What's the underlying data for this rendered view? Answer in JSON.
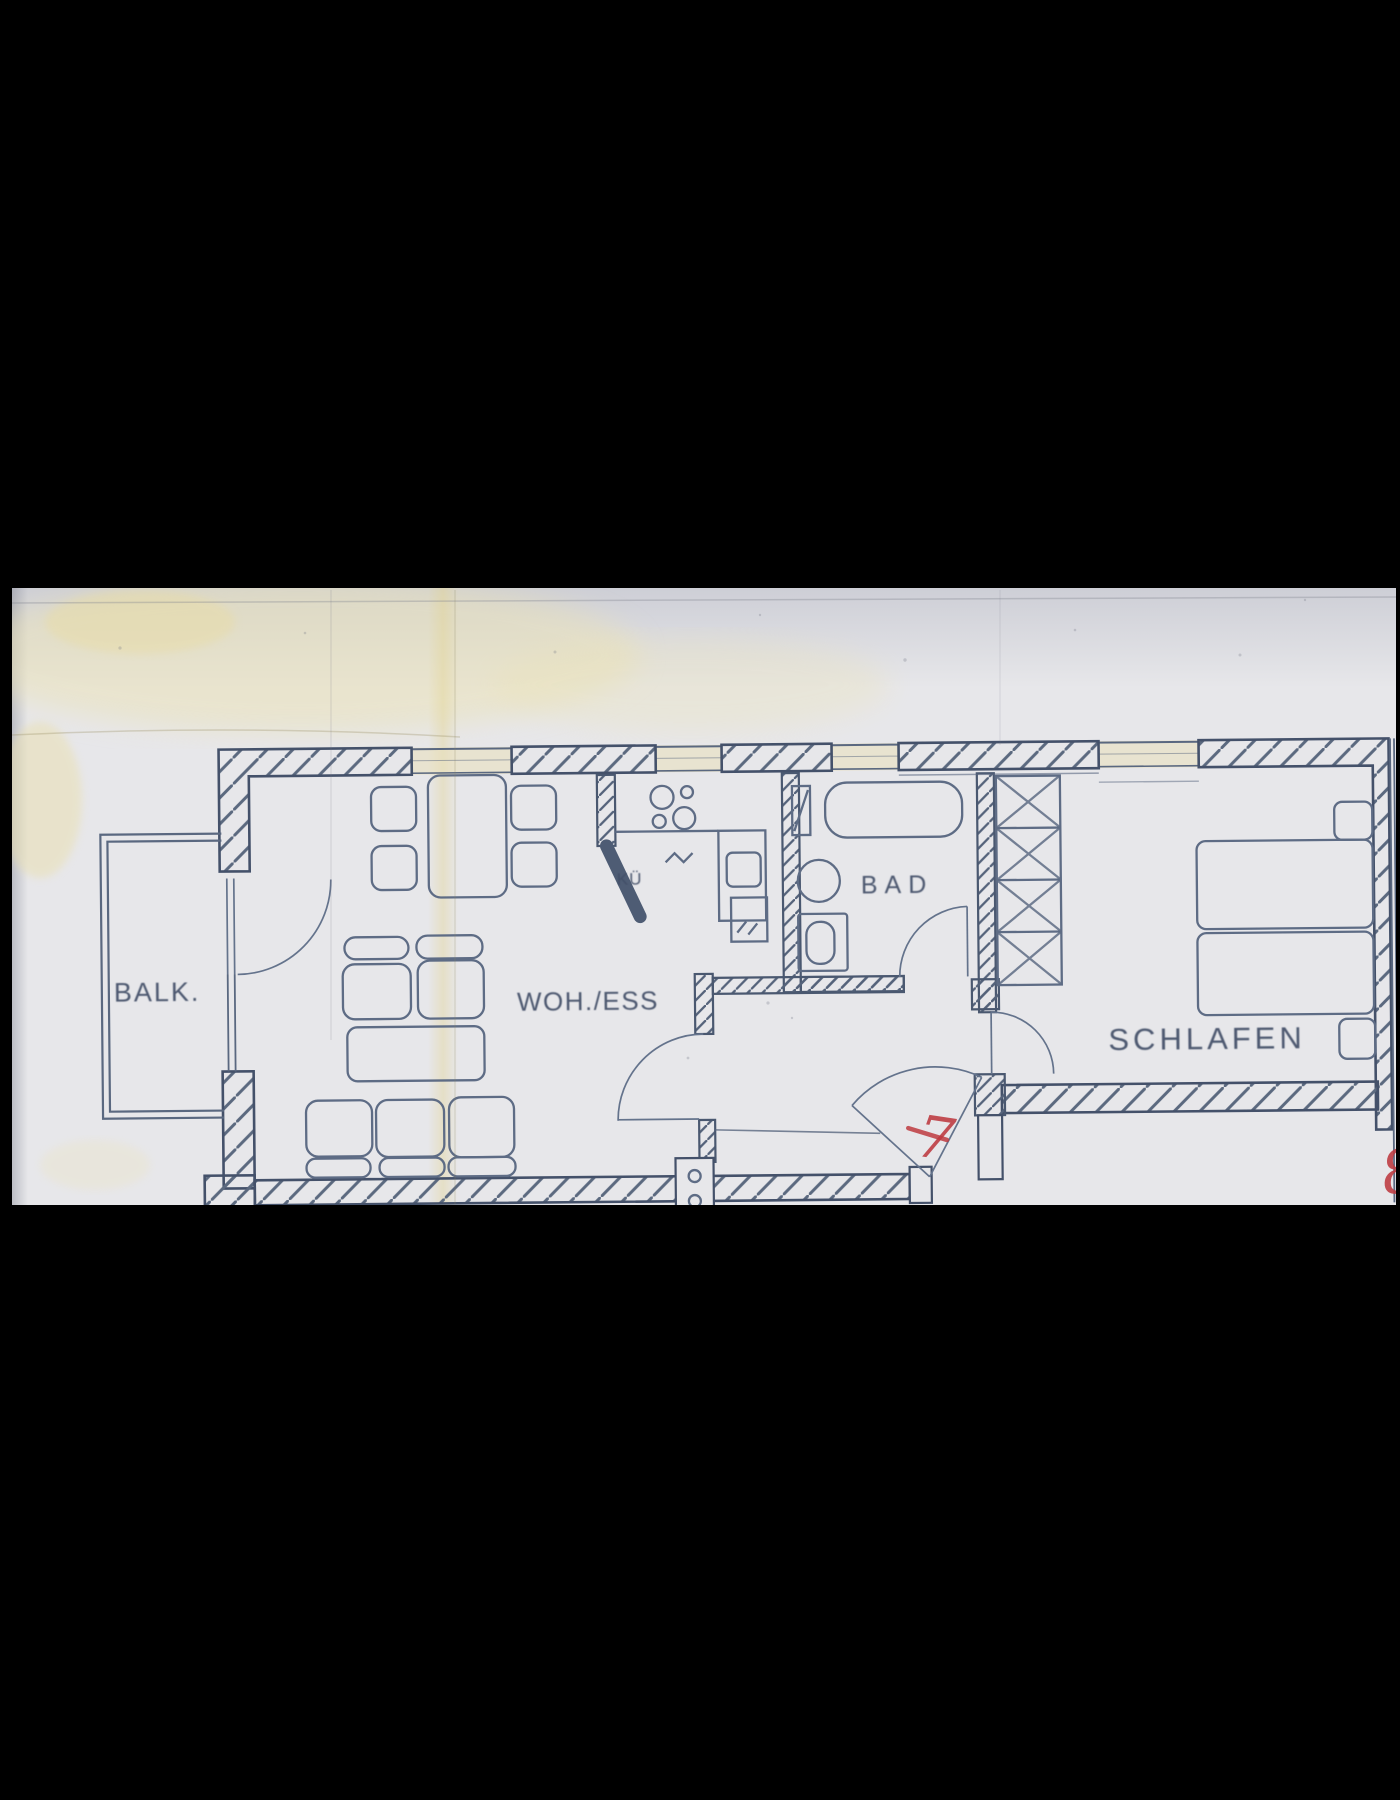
{
  "document": {
    "type": "scanned-floor-plan",
    "description": "Black-letterboxed scan of an apartment floor plan"
  },
  "rooms": {
    "balcony": {
      "label": "BALK."
    },
    "living_dining": {
      "label": "WOH./ESS"
    },
    "kitchen": {
      "label": "KÜ"
    },
    "bath": {
      "label": "BAD"
    },
    "bedroom": {
      "label": "SCHLAFEN"
    }
  },
  "annotations": {
    "entry_door_mark": {
      "text": "7",
      "color": "#bd3a40"
    },
    "right_edge_mark": {
      "text": "8",
      "color": "#bd3a40"
    }
  },
  "colors": {
    "letterbox": "#000000",
    "paper": "#e7e7ea",
    "ink": "#44516a",
    "furniture_line": "#5e6c85",
    "stain": "#e9dfb2",
    "annotation_red": "#bd3a40"
  },
  "icons": {
    "hatched-wall": "diagonal-line-pattern",
    "door-swing": "quarter-arc",
    "wardrobe": "x-lattice-rect",
    "stove": "four-burner-circles",
    "utility-shaft": "box-with-two-circles"
  }
}
